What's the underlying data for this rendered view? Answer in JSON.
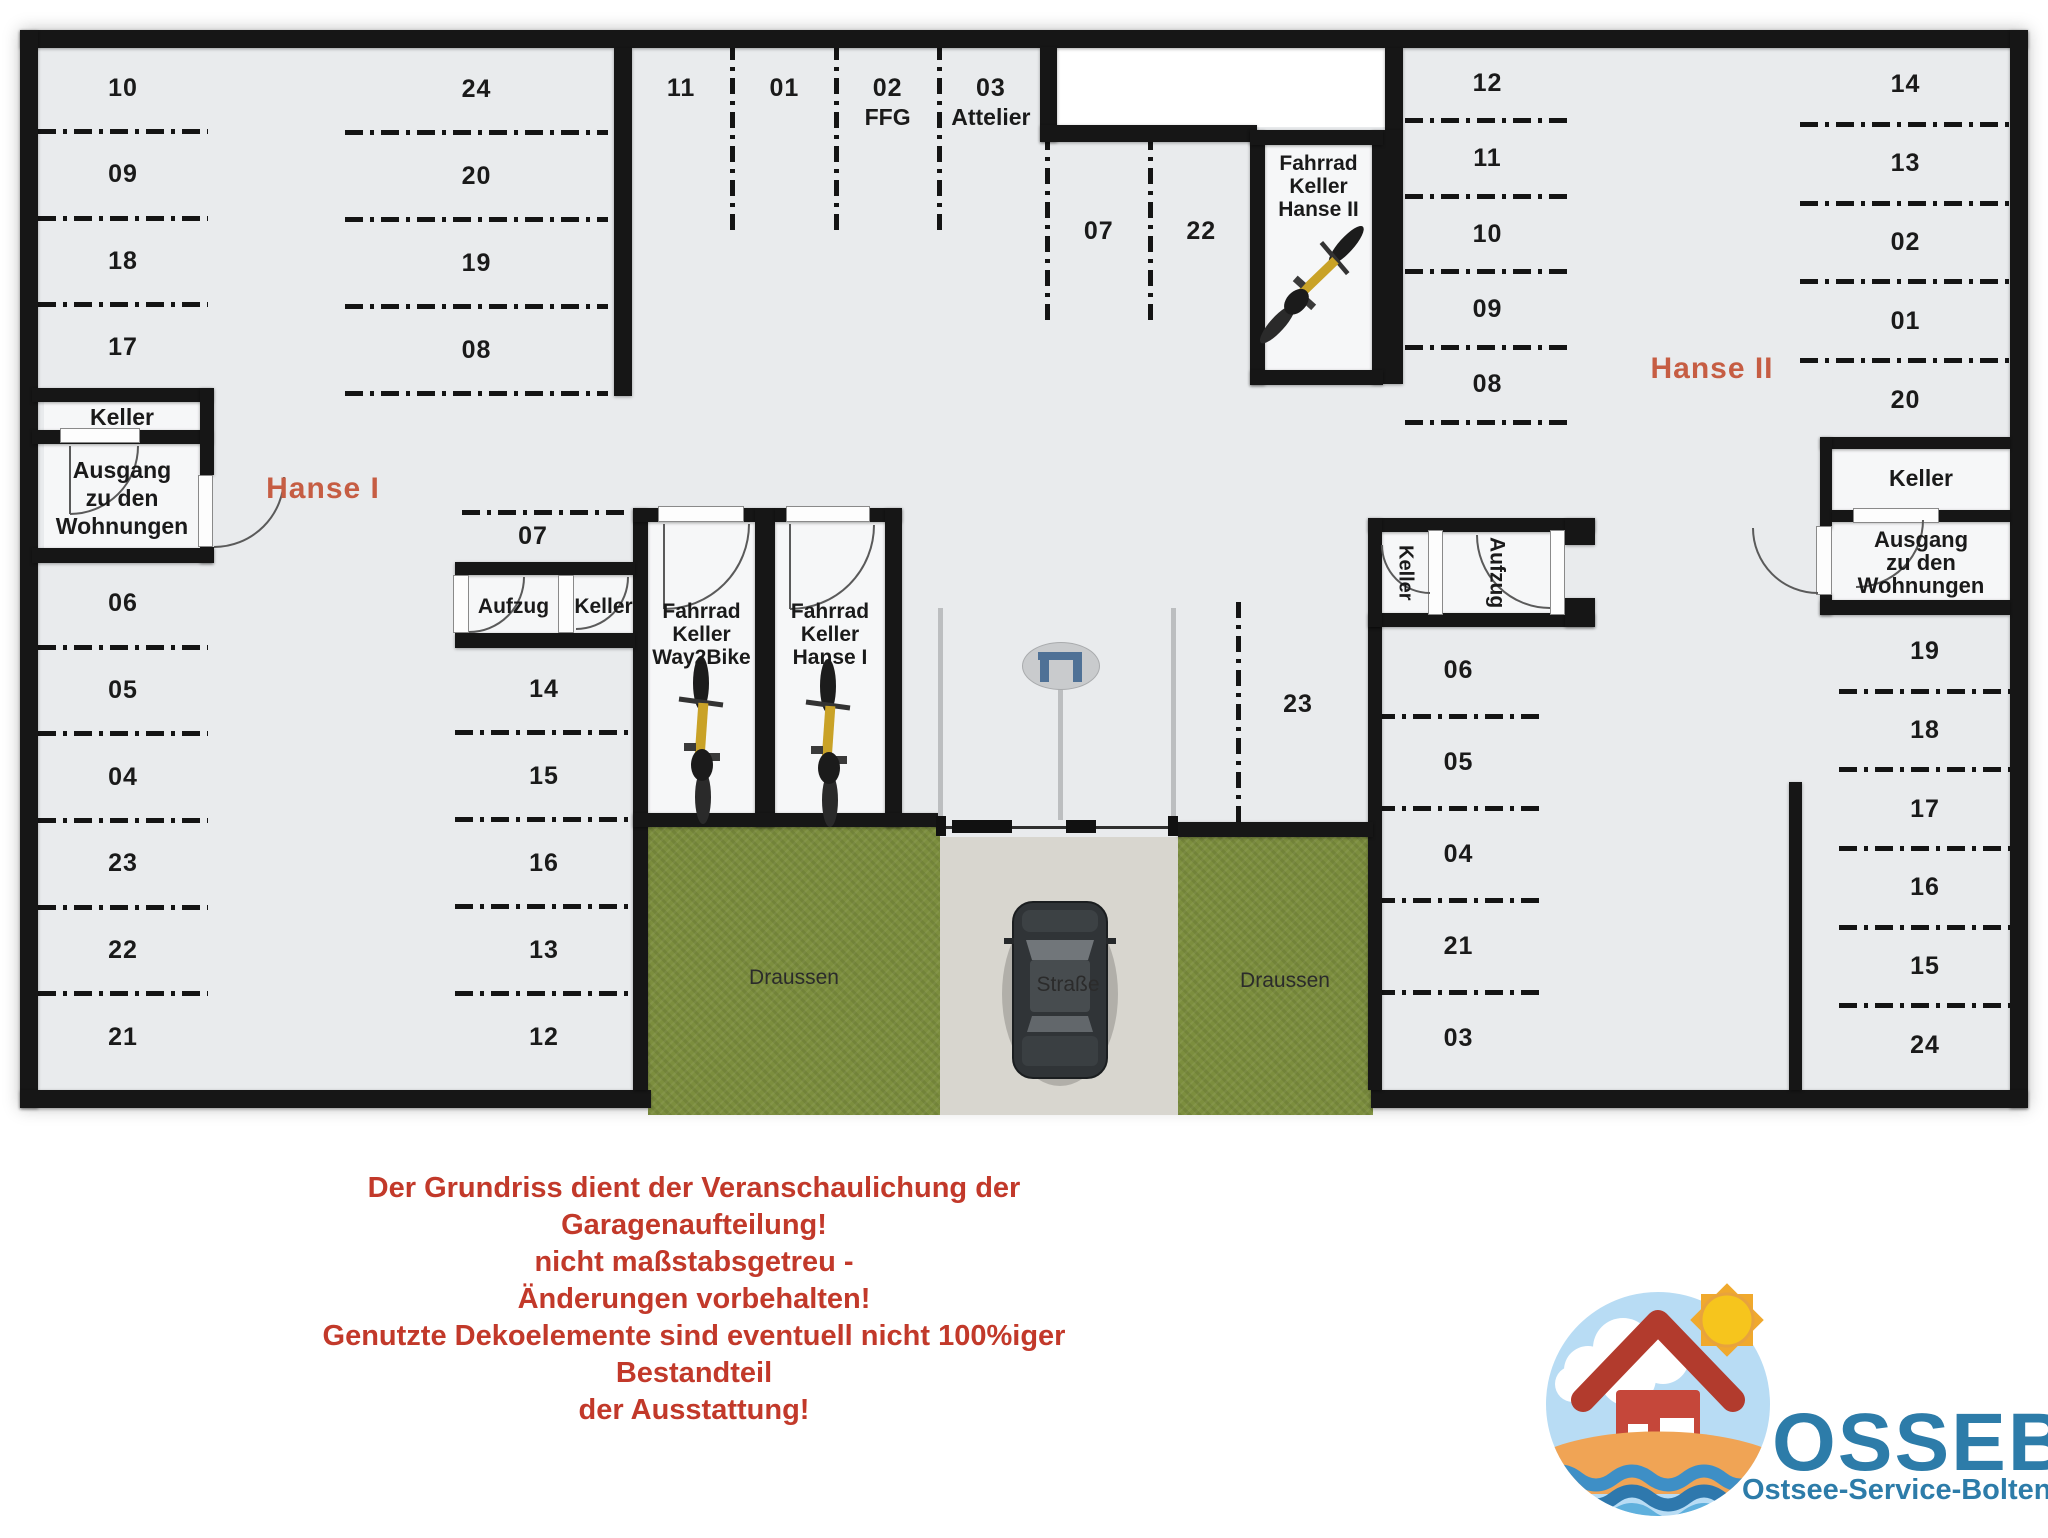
{
  "building_labels": {
    "hanse1": "Hanse I",
    "hanse2": "Hanse II"
  },
  "zones": {
    "hanse1_west_top": [
      "10",
      "09",
      "18",
      "17"
    ],
    "hanse1_west_bottom": [
      "06",
      "05",
      "04",
      "23",
      "22",
      "21"
    ],
    "hanse1_col2_top": [
      "24",
      "20",
      "19",
      "08"
    ],
    "top_middle": [
      {
        "label": "11"
      },
      {
        "label": "01"
      },
      {
        "label": "02",
        "sub": "FFG"
      },
      {
        "label": "03",
        "sub": "Attelier"
      }
    ],
    "mid_07_22": [
      "07",
      "22"
    ],
    "col2_spot_07": "07",
    "hanse1_col2_bottom": [
      "14",
      "15",
      "16",
      "13",
      "12"
    ],
    "aisle_spot": "23",
    "hanse2_nw": [
      "12",
      "11",
      "10",
      "09",
      "08"
    ],
    "hanse2_ne": [
      "14",
      "13",
      "02",
      "01",
      "20"
    ],
    "hanse2_sw": [
      "06",
      "05",
      "04",
      "21",
      "03"
    ],
    "hanse2_se": [
      "19",
      "18",
      "17",
      "16",
      "15",
      "24"
    ]
  },
  "rooms": {
    "keller_west": "Keller",
    "ausgang_west": [
      "Ausgang",
      "zu den",
      "Wohnungen"
    ],
    "aufzug_left": "Aufzug",
    "keller_left": "Keller",
    "fahrrad_way2bike": [
      "Fahrrad",
      "Keller",
      "Way2Bike"
    ],
    "fahrrad_hanse1": [
      "Fahrrad",
      "Keller",
      "Hanse I"
    ],
    "fahrrad_hanse2": [
      "Fahrrad",
      "Keller",
      "Hanse II"
    ],
    "keller_mid_right": "Keller",
    "aufzug_mid_right": "Aufzug",
    "keller_east": "Keller",
    "ausgang_east": [
      "Ausgang",
      "zu den",
      "Wohnungen"
    ]
  },
  "outdoor": {
    "draussen_left": "Draussen",
    "draussen_right": "Draussen",
    "strasse": "Straße"
  },
  "disclaimer": [
    "Der Grundriss dient der Veranschaulichung der Garagenaufteilung!",
    "nicht maßstabsgetreu -",
    "Änderungen vorbehalten!",
    "Genutzte Dekoelemente sind eventuell nicht 100%iger Bestandteil",
    "der Ausstattung!"
  ],
  "logo": {
    "brand": "OSSEBO",
    "subtitle": "Ostsee-Service-Boltenhagen GmbH"
  },
  "icons": {
    "bicycle-icon": "top-view bicycle, yellow frame, dark wheels",
    "car-top-view-icon": "dark gray car seen from above on the street",
    "gate-barrier-icon": "blue gate symbol inside gray ellipse",
    "sun-icon": "yellow sun with rays",
    "house-icon": "red house with white door and window",
    "cloud-icon": "white cloud",
    "waves-icon": "blue sea waves",
    "beach-icon": "orange sand band"
  },
  "colors": {
    "wall": "#161616",
    "floor": "#e9ebed",
    "accent": "#c65d43",
    "disclaimer_red": "#c2392a",
    "logo_blue": "#2d7ca9",
    "grass": "#7c8e3e",
    "street": "#d8d6cf",
    "bike_frame": "#c9a227",
    "room_white": "#f6f7f8"
  }
}
